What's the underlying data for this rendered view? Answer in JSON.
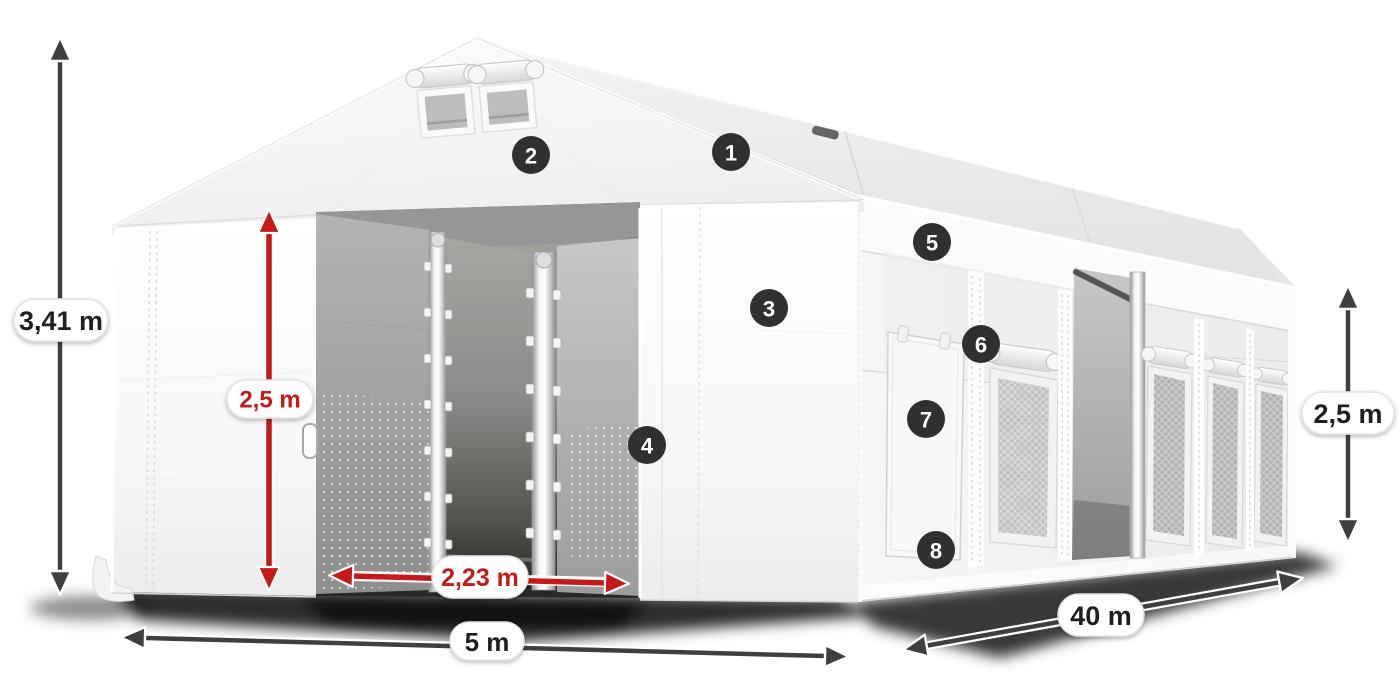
{
  "illustration": {
    "description": "3D product diagram of a white tarpaulin storage tent with open gable entrance, two roof vents, side door and mesh side windows"
  },
  "dimensions": {
    "total_height": {
      "value": "3,41 m",
      "color": "dark"
    },
    "entrance_height": {
      "value": "2,5 m",
      "color": "red"
    },
    "entrance_width": {
      "value": "2,23 m",
      "color": "red"
    },
    "front_width": {
      "value": "5 m",
      "color": "dark"
    },
    "length": {
      "value": "40 m",
      "color": "dark"
    },
    "side_wall_height": {
      "value": "2,5 m",
      "color": "dark"
    }
  },
  "callouts": [
    "1",
    "2",
    "3",
    "4",
    "5",
    "6",
    "7",
    "8"
  ],
  "colors": {
    "dimension_dark": "#3f3f3f",
    "dimension_red": "#c41a1a",
    "badge_background": "#303030",
    "badge_text": "#ffffff",
    "background": "#ffffff"
  }
}
